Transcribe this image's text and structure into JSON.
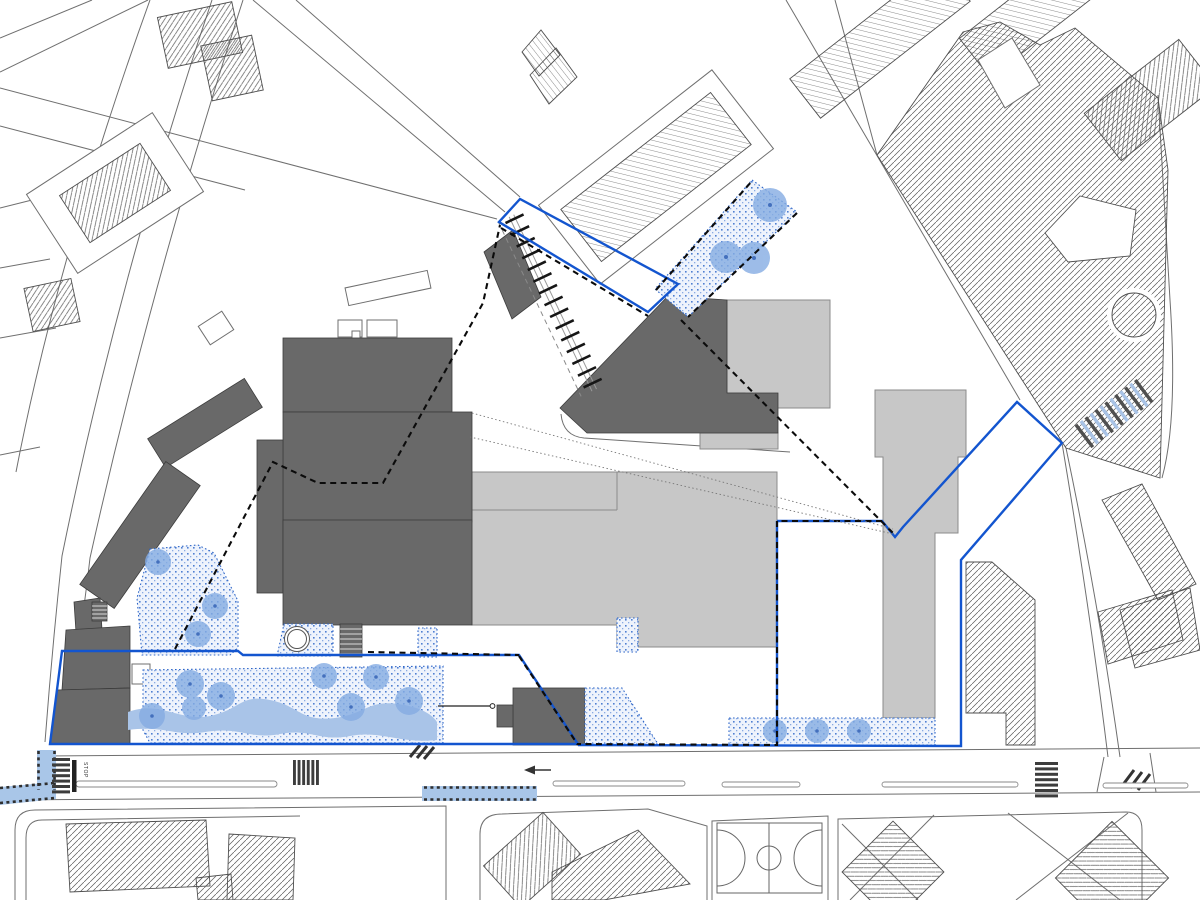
{
  "labels": {
    "bus_stop": "STOP"
  },
  "colors": {
    "boundary_blue": "#1355cf",
    "dashed_black": "#0b0b0b",
    "dark_building": "#696969",
    "light_building": "#c7c7c7",
    "hatch_line": "#4f4f4f",
    "road_line": "#6f6f6f",
    "green_dot": "#4f7fd2",
    "green_fill": "#eef3fc",
    "tree": "#85ace3",
    "tree_core": "#4470bd",
    "shrub": "#a9c4e8",
    "path_blue": "#a9c6e8",
    "ramp_stripe_blue": "#a9c3e6",
    "ramp_stripe_dark": "#4f4f4f",
    "crosswalk": "#3d3d3d"
  },
  "layers": [
    "context-roads-and-parcels",
    "context-hatched-buildings",
    "project-dark-buildings",
    "existing-light-buildings",
    "green-areas-dotted",
    "shrub-band",
    "trees",
    "blue-paved-paths",
    "crosswalks",
    "stair-ramp",
    "road-markings",
    "basketball-court",
    "site-boundary-blue",
    "site-boundary-dashed",
    "sight-lines"
  ],
  "counts": {
    "trees": 17,
    "tree_wells": 1
  }
}
